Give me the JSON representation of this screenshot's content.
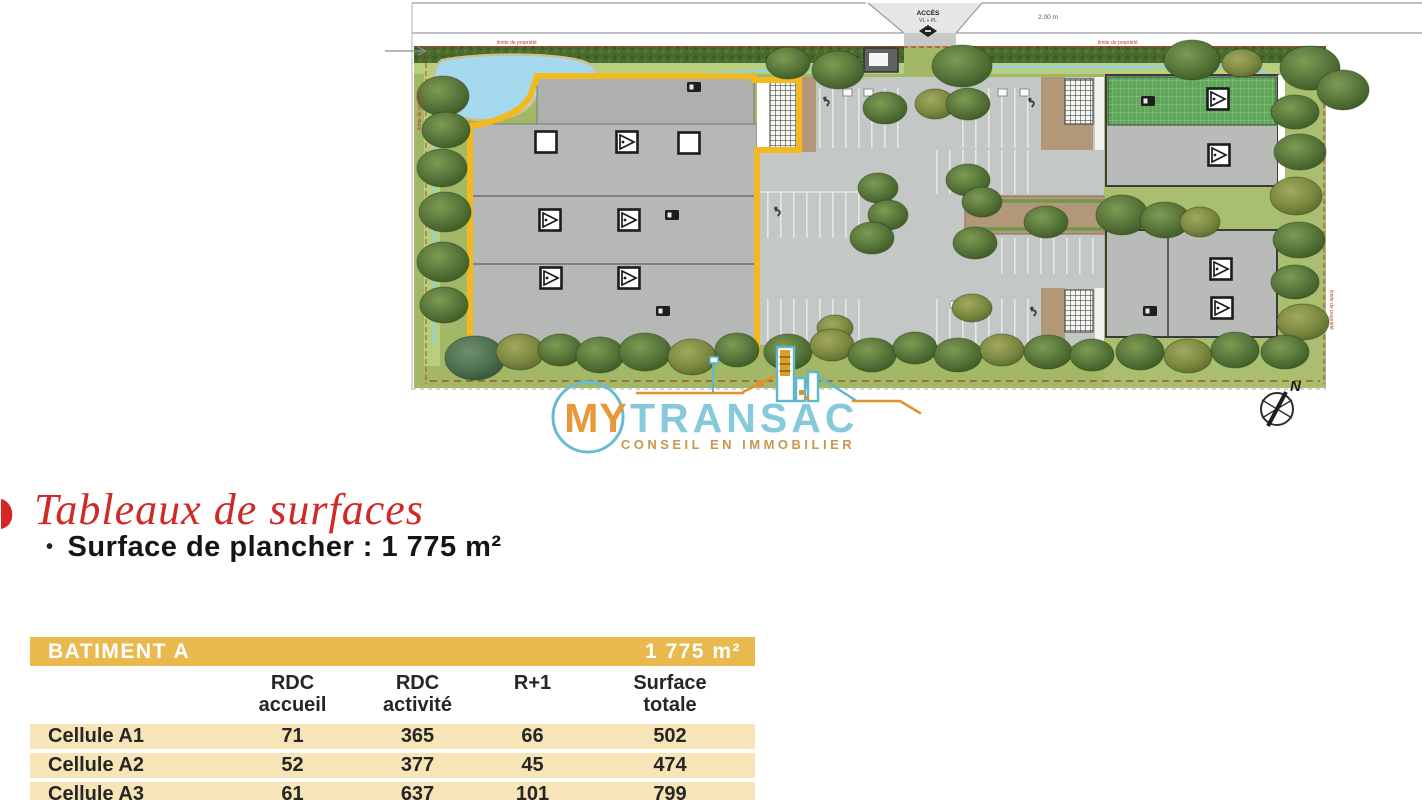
{
  "plan": {
    "road": {
      "access_label": "ACCÈS",
      "access_type": "VL + PL",
      "width_label": "2.00 m"
    },
    "boundary_labels": [
      "limite de propriété",
      "limite de propriété",
      "limite de propriété",
      "limite de propriété"
    ],
    "compass_north": "N"
  },
  "logo": {
    "word_my": "MY",
    "word_transac": "TRANSAC",
    "tagline": "CONSEIL EN IMMOBILIER"
  },
  "section": {
    "title": "Tableaux de surfaces",
    "bullet": "•",
    "surface_line": "Surface de plancher : 1 775 m²"
  },
  "table": {
    "title": "BATIMENT A",
    "total_label": "1 775 m²",
    "col_headers": [
      {
        "l1": "RDC",
        "l2": "accueil"
      },
      {
        "l1": "RDC",
        "l2": "activité"
      },
      {
        "l1": "R+1",
        "l2": ""
      },
      {
        "l1": "Surface",
        "l2": "totale"
      }
    ],
    "rows": [
      {
        "label": "Cellule A1",
        "values": [
          "71",
          "365",
          "66",
          "502"
        ]
      },
      {
        "label": "Cellule A2",
        "values": [
          "52",
          "377",
          "45",
          "474"
        ]
      },
      {
        "label": "Cellule A3",
        "values": [
          "61",
          "637",
          "101",
          "799"
        ]
      }
    ]
  },
  "colors": {
    "accent_red": "#d12828",
    "table_header_gold": "#e9b94e",
    "table_row_cream": "#f8e5b7",
    "plan_outline_yellow": "#f2ba1e",
    "logo_teal": "#7fc6d8",
    "logo_orange": "#e8973b",
    "logo_gold": "#c9964a"
  }
}
